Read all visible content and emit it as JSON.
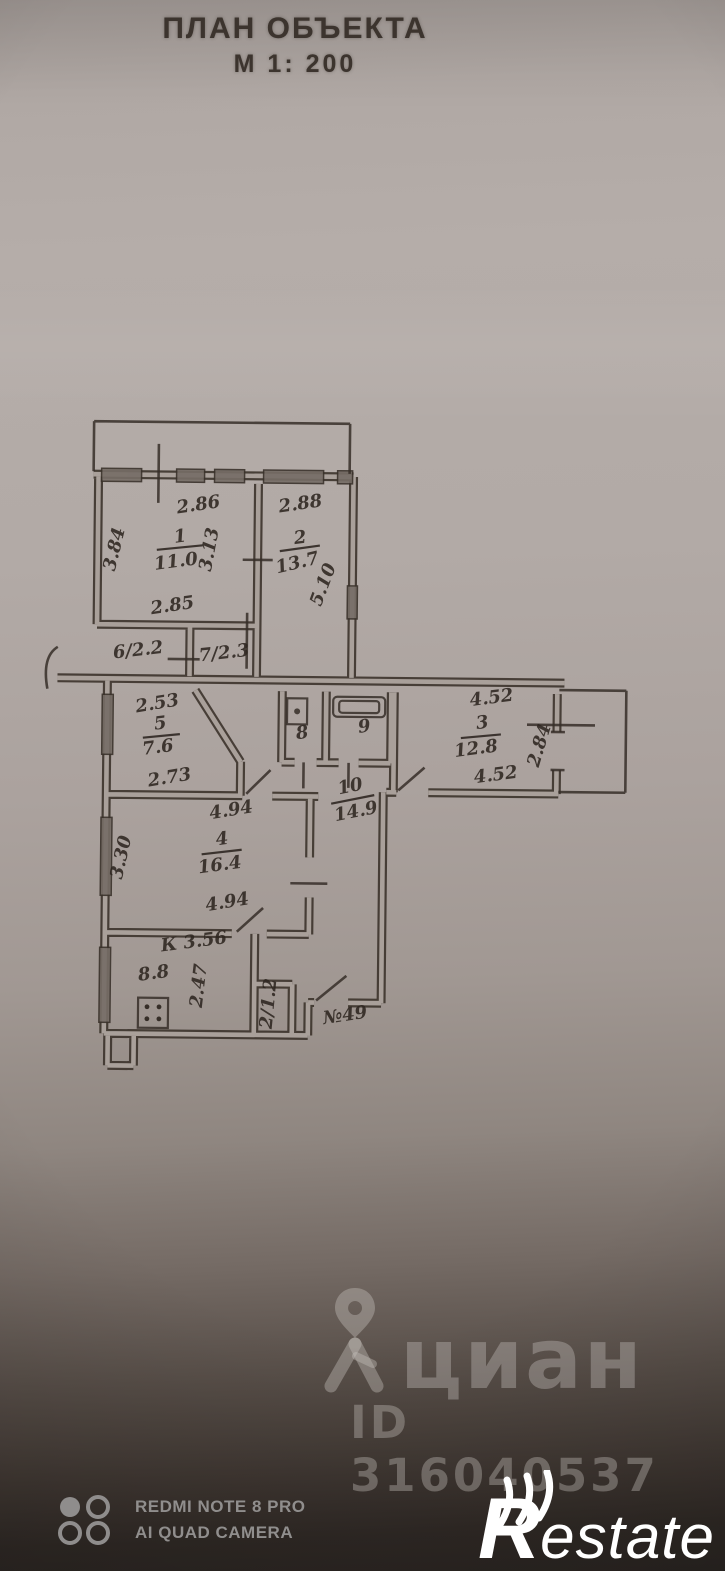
{
  "header": {
    "title": "ПЛАН ОБЪЕКТА",
    "scale": "М 1: 200"
  },
  "plan": {
    "labels": [
      {
        "name": "room1-top-width",
        "text": "2.86"
      },
      {
        "name": "room2-top-width",
        "text": "2.88"
      },
      {
        "name": "room1-number",
        "text": "1"
      },
      {
        "name": "room1-area",
        "text": "11.0"
      },
      {
        "name": "room2-number",
        "text": "2"
      },
      {
        "name": "room2-area",
        "text": "13.7"
      },
      {
        "name": "room1-left-height",
        "text": "3.84"
      },
      {
        "name": "room1-right-height",
        "text": "3.13"
      },
      {
        "name": "room2-right-height",
        "text": "5.10"
      },
      {
        "name": "room1-bottom-width",
        "text": "2.85"
      },
      {
        "name": "closet6-label",
        "text": "6/2.2"
      },
      {
        "name": "closet7-label",
        "text": "7/2.3"
      },
      {
        "name": "room5-top-width",
        "text": "2.53"
      },
      {
        "name": "room5-number",
        "text": "5"
      },
      {
        "name": "room5-area",
        "text": "7.6"
      },
      {
        "name": "room5-bottom-width",
        "text": "2.73"
      },
      {
        "name": "room4-top-width",
        "text": "4.94"
      },
      {
        "name": "room4-number",
        "text": "4"
      },
      {
        "name": "room4-area",
        "text": "16.4"
      },
      {
        "name": "room4-bottom-width",
        "text": "4.94"
      },
      {
        "name": "room4-left-height",
        "text": "3.30"
      },
      {
        "name": "kitchen-label",
        "text": "К 3.56"
      },
      {
        "name": "kitchen-area",
        "text": "8.8"
      },
      {
        "name": "kitchen-height",
        "text": "2.47"
      },
      {
        "name": "room8-number",
        "text": "8"
      },
      {
        "name": "room9-number",
        "text": "9"
      },
      {
        "name": "room10-number",
        "text": "10"
      },
      {
        "name": "room10-area",
        "text": "14.9"
      },
      {
        "name": "room3-top-width",
        "text": "4.52"
      },
      {
        "name": "room3-number",
        "text": "3"
      },
      {
        "name": "room3-area",
        "text": "12.8"
      },
      {
        "name": "room3-bottom-width",
        "text": "4.52"
      },
      {
        "name": "room3-right-height",
        "text": "2.84"
      },
      {
        "name": "closet-small-label",
        "text": "2/1.2"
      },
      {
        "name": "apartment-number",
        "text": "№49"
      }
    ]
  },
  "watermarks": {
    "cian": {
      "logo": "циан",
      "id": "ID 316040537"
    },
    "camera": {
      "line1": "REDMI NOTE 8 PRO",
      "line2": "AI QUAD CAMERA"
    },
    "restate": {
      "initial": "R",
      "rest": "estate"
    }
  },
  "colors": {
    "paper": "#b2aaa6",
    "ink": "#2d2520",
    "photo_shadow": "#292421",
    "watermark": "#c6c0bc"
  }
}
